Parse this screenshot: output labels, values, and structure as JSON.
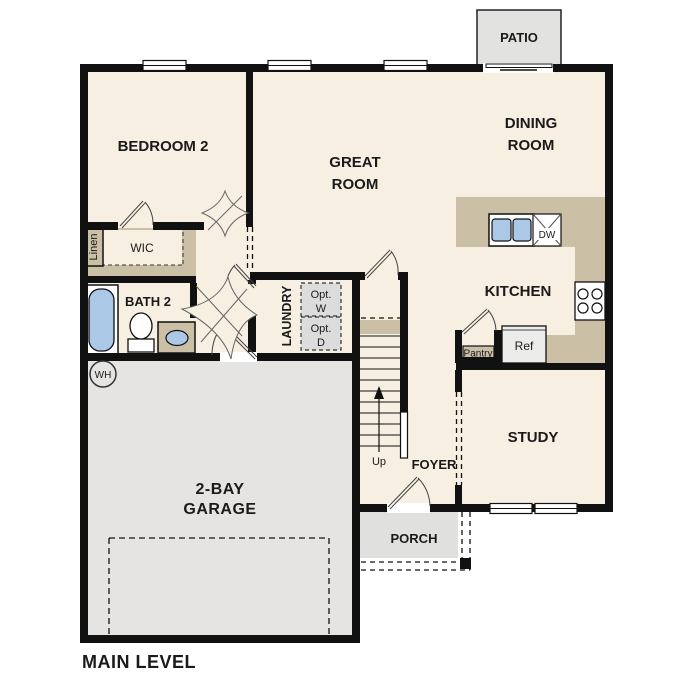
{
  "plan": {
    "level_label": "MAIN LEVEL",
    "rooms": {
      "patio": "PATIO",
      "bedroom2": "BEDROOM 2",
      "great_room": [
        "GREAT",
        "ROOM"
      ],
      "dining_room": [
        "DINING",
        "ROOM"
      ],
      "kitchen": "KITCHEN",
      "bath2": "BATH 2",
      "wic": "WIC",
      "linen": "Linen",
      "laundry": "LAUNDRY",
      "study": "STUDY",
      "foyer": "FOYER",
      "porch": "PORCH",
      "garage": [
        "2-BAY",
        "GARAGE"
      ]
    },
    "fixtures": {
      "opt_washer": [
        "Opt.",
        "W"
      ],
      "opt_dryer": [
        "Opt.",
        "D"
      ],
      "water_heater": "WH",
      "dishwasher": "DW",
      "refrigerator": "Ref",
      "pantry": "Pantry",
      "stairs_direction": "Up"
    },
    "colors": {
      "wall": "#111111",
      "interior": "#f7efe2",
      "counter": "#cbbfa6",
      "garage": "#e5e4e2",
      "patio": "#e2e2e0",
      "porch": "#e0e0de",
      "plumbing_blue": "#abc8e7",
      "optional_appliance": "#dcdcdc",
      "appliance_white": "#ffffff"
    }
  }
}
